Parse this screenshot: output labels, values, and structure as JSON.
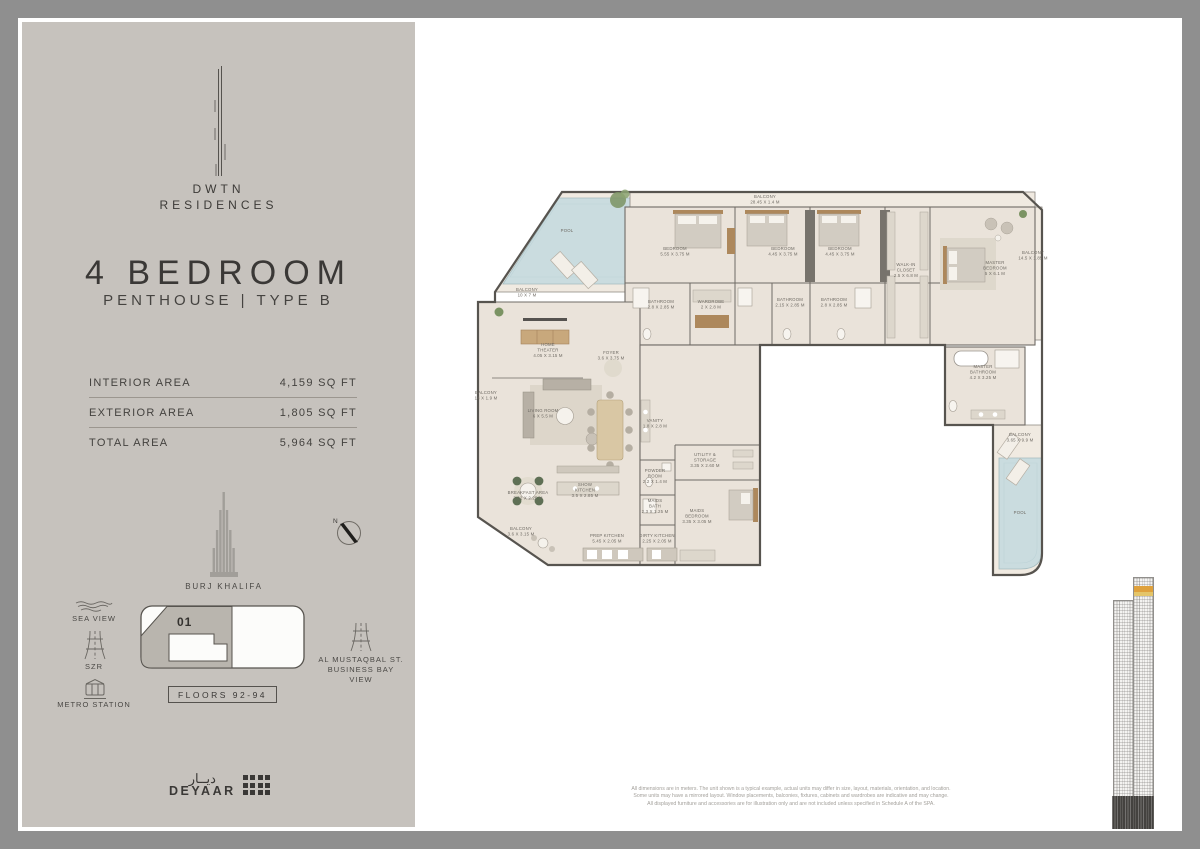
{
  "brand": {
    "line1": "DWTN",
    "line2": "RESIDENCES"
  },
  "unit": {
    "title": "4 BEDROOM",
    "subtitle": "PENTHOUSE | TYPE B"
  },
  "areas": {
    "rows": [
      {
        "label": "INTERIOR AREA",
        "value": "4,159 SQ FT"
      },
      {
        "label": "EXTERIOR AREA",
        "value": "1,805 SQ FT"
      },
      {
        "label": "TOTAL AREA",
        "value": "5,964 SQ FT"
      }
    ]
  },
  "landmarks": {
    "compass_n": "N",
    "burj": "BURJ KHALIFA",
    "sea_view": "SEA VIEW",
    "szr": "SZR",
    "metro": "METRO STATION",
    "almustaqbal_line1": "AL MUSTAQBAL ST.",
    "almustaqbal_line2": "BUSINESS BAY",
    "almustaqbal_line3": "VIEW",
    "keyplan_unit": "01",
    "floors_badge": "FLOORS 92-94"
  },
  "logo": {
    "deyaar_arabic": "ديــار",
    "deyaar_en": "DEYAAR"
  },
  "floor_plan": {
    "rooms": [
      {
        "lines": [
          "POOL"
        ],
        "x": 132,
        "y": 82
      },
      {
        "lines": [
          "BALCONY",
          "10 X 7 M"
        ],
        "x": 92,
        "y": 141
      },
      {
        "lines": [
          "BALCONY",
          "28.45 X 1.4 M"
        ],
        "x": 330,
        "y": 48
      },
      {
        "lines": [
          "BEDROOM",
          "5.55 X 3.75 M"
        ],
        "x": 240,
        "y": 100
      },
      {
        "lines": [
          "BEDROOM",
          "4.45 X 3.75 M"
        ],
        "x": 348,
        "y": 100
      },
      {
        "lines": [
          "BEDROOM",
          "4.45 X 3.75 M"
        ],
        "x": 405,
        "y": 100
      },
      {
        "lines": [
          "WALK-IN",
          "CLOSET",
          "2.5 X 6.8 M"
        ],
        "x": 471,
        "y": 116
      },
      {
        "lines": [
          "MASTER",
          "BEDROOM",
          "5 X 6.1 M"
        ],
        "x": 560,
        "y": 114
      },
      {
        "lines": [
          "BALCONY",
          "14.5 X 1.85 M"
        ],
        "x": 598,
        "y": 104
      },
      {
        "lines": [
          "BATHROOM",
          "2.8 X 2.85 M"
        ],
        "x": 226,
        "y": 153
      },
      {
        "lines": [
          "WARDROBE",
          "2 X 2.8 M"
        ],
        "x": 276,
        "y": 153
      },
      {
        "lines": [
          "BATHROOM",
          "2.15 X 2.85 M"
        ],
        "x": 355,
        "y": 151
      },
      {
        "lines": [
          "BATHROOM",
          "2.8 X 2.85 M"
        ],
        "x": 399,
        "y": 151
      },
      {
        "lines": [
          "MASTER",
          "BATHROOM",
          "4.2 X 3.25 M"
        ],
        "x": 548,
        "y": 218
      },
      {
        "lines": [
          "BALCONY",
          "3.65 X 9.9 M"
        ],
        "x": 585,
        "y": 286
      },
      {
        "lines": [
          "POOL"
        ],
        "x": 585,
        "y": 364
      },
      {
        "lines": [
          "HOME",
          "THEATER",
          "4.05 X 3.15 M"
        ],
        "x": 113,
        "y": 196
      },
      {
        "lines": [
          "FOYER",
          "3.6 X 3.75 M"
        ],
        "x": 176,
        "y": 204
      },
      {
        "lines": [
          "LIVING ROOM",
          "6 X 5.5 M"
        ],
        "x": 108,
        "y": 262
      },
      {
        "lines": [
          "VANITY",
          "1.8 X 2.8 M"
        ],
        "x": 220,
        "y": 272
      },
      {
        "lines": [
          "BALCONY",
          "14 X 1.9 M"
        ],
        "x": 51,
        "y": 244
      },
      {
        "lines": [
          "UTILITY &",
          "STORAGE",
          "3.35 X 2.60 M"
        ],
        "x": 270,
        "y": 306
      },
      {
        "lines": [
          "POWDER",
          "ROOM",
          "2.2 X 1.4 M"
        ],
        "x": 220,
        "y": 322
      },
      {
        "lines": [
          "MAIDS",
          "BATH",
          "2.3 X 1.25 M"
        ],
        "x": 220,
        "y": 352
      },
      {
        "lines": [
          "MAIDS",
          "BEDROOM",
          "3.35 X 3.05 M"
        ],
        "x": 262,
        "y": 362
      },
      {
        "lines": [
          "BREAKFAST AREA",
          "3.62 X 2.25 M"
        ],
        "x": 93,
        "y": 344
      },
      {
        "lines": [
          "SHOW",
          "KITCHEN",
          "3.5 X 2.85 M"
        ],
        "x": 150,
        "y": 336
      },
      {
        "lines": [
          "PREP KITCHEN",
          "5.45 X 2.05 M"
        ],
        "x": 172,
        "y": 387
      },
      {
        "lines": [
          "DIRTY KITCHEN",
          "2.25 X 2.05 M"
        ],
        "x": 222,
        "y": 387
      },
      {
        "lines": [
          "BALCONY",
          "3.6 X 3.15 M"
        ],
        "x": 86,
        "y": 380
      }
    ]
  },
  "disclaimer": {
    "line1": "All dimensions are in meters. The unit shown is a typical example, actual units may differ in size, layout, materials, orientation, and location.",
    "line2": "Some units may have a mirrored layout. Window placements, balconies, fixtures, cabinets and wardrobes are indicative and may change.",
    "line3": "All displayed furniture and accessories are for illustration only and are not included unless specified in Schedule A of the SPA."
  },
  "colors": {
    "sidebar_bg": "#c6c2bd",
    "frame": "#8f8f8f",
    "floor": "#eae3da",
    "balcony": "#f0eae1",
    "pool": "#cadcdf",
    "wall": "#57544f",
    "highlight_orange": "#dfa13c",
    "text_dark": "#3a3836"
  }
}
